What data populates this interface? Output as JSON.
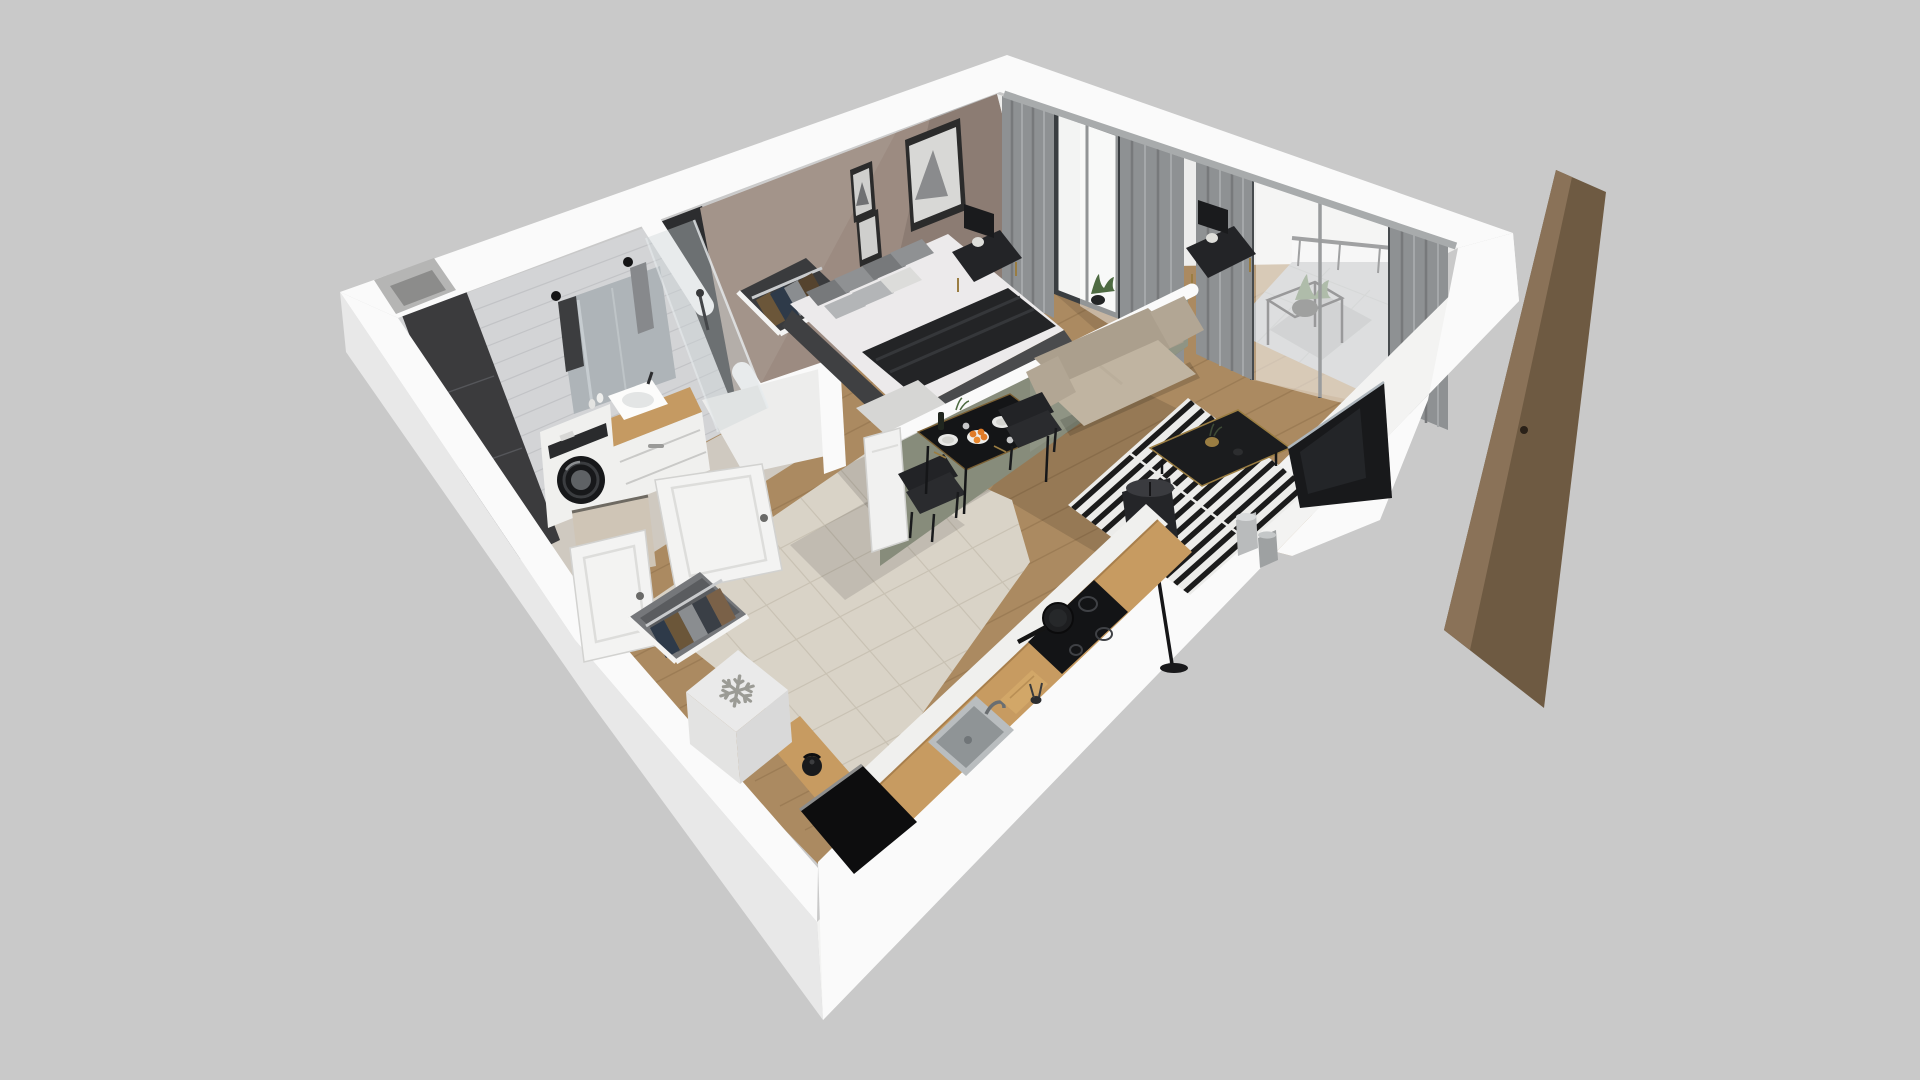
{
  "meta": {
    "description": "3D isometric dollhouse render of a studio apartment floor plan, no visible text",
    "view": "perspective top-down cutaway on plain gray background"
  },
  "colors": {
    "background": "#c9c9c9",
    "wall_cap": "#fafafa",
    "wall_outer_shade": "#e8e8e8",
    "wall_outer_bright": "#f3f3f2",
    "wall_interior_white": "#ededec",
    "bath_tile_light": "#d3d4d6",
    "bath_tile_grout": "#c2c3c6",
    "bath_tile_dark": "#3b3b3d",
    "niche_dark": "#2c2d2f",
    "wall_mauve": "#9c8b81",
    "wall_sage": "#878c7b",
    "floor_wood": "#ab8a61",
    "floor_wood_line": "#8d6f4a",
    "floor_tile": "#d9d3c7",
    "floor_tile_grout": "#c7c0b2",
    "floor_bath": "#cfc9c0",
    "balcony_concrete": "#b7babb",
    "balcony_mat": "#9da1a2",
    "window_glass": "#f3f4f3",
    "window_frame": "#3a3e41",
    "curtain_gray": "#8e9193",
    "curtain_fold": "#77797b",
    "curtain_sheer": "#ffffff",
    "sofa_beige": "#ab9f8d",
    "sofa_beige_light": "#c0b4a1",
    "rug_white": "#ececea",
    "rug_black": "#1b1b1b",
    "furniture_black": "#1b1c1e",
    "gold_accent": "#9a7d42",
    "counter_wood": "#c79b61",
    "appliance_white": "#f0f0ee",
    "fridge_snowflake": "#9b9b95",
    "orange_fruit": "#e07b28",
    "plant_green": "#4e6b42",
    "door_wood": "#6e5a42",
    "door_wood_light": "#8a7258",
    "entry_void": "#0d0d0e",
    "sink_metal": "#8f9496",
    "bed_linen": "#eceaeb",
    "bed_throw": "#232426",
    "pillow_dark": "#77797b",
    "pillow_light": "#b3b5b7"
  },
  "icons": [
    {
      "name": "snowflake-icon",
      "meaning": "freezer/fridge marker on appliance top",
      "color": "#9b9b95"
    }
  ],
  "scene": {
    "rooms": [
      {
        "name": "bathroom",
        "objects": [
          "washing-machine",
          "vanity-sink",
          "mirror",
          "towel-hooks",
          "shower-glass",
          "dark-accent-tiles",
          "leaning-panel",
          "duct-shaft"
        ]
      },
      {
        "name": "bedroom",
        "objects": [
          "double-bed",
          "pillows",
          "dark-throw",
          "bench",
          "nightstand-left",
          "nightstand-right",
          "table-lamps",
          "wall-art-frames",
          "open-closet-clothes",
          "plant"
        ]
      },
      {
        "name": "living-room",
        "objects": [
          "loveseat-sofa",
          "striped-rug",
          "coffee-table",
          "gold-vase",
          "floor-lamp",
          "television",
          "floor-vases",
          "half-wall-sage"
        ]
      },
      {
        "name": "dining-area",
        "objects": [
          "black-table",
          "two-chairs",
          "plates",
          "fruit-bowl-oranges",
          "bottle",
          "glasses"
        ]
      },
      {
        "name": "kitchen",
        "objects": [
          "wood-countertop",
          "induction-hob",
          "frying-pan",
          "sink",
          "faucet",
          "cutting-board",
          "kettle",
          "fridge-with-snowflake",
          "entry-wardrobe"
        ]
      },
      {
        "name": "balcony",
        "objects": [
          "glass-slider",
          "plant-stand",
          "railing",
          "concrete-floor",
          "gray-mat",
          "curtains"
        ]
      },
      {
        "name": "hallway",
        "objects": [
          "beige-tile-floor",
          "white-doors",
          "entry-void",
          "open-wood-door-panel"
        ]
      }
    ]
  }
}
